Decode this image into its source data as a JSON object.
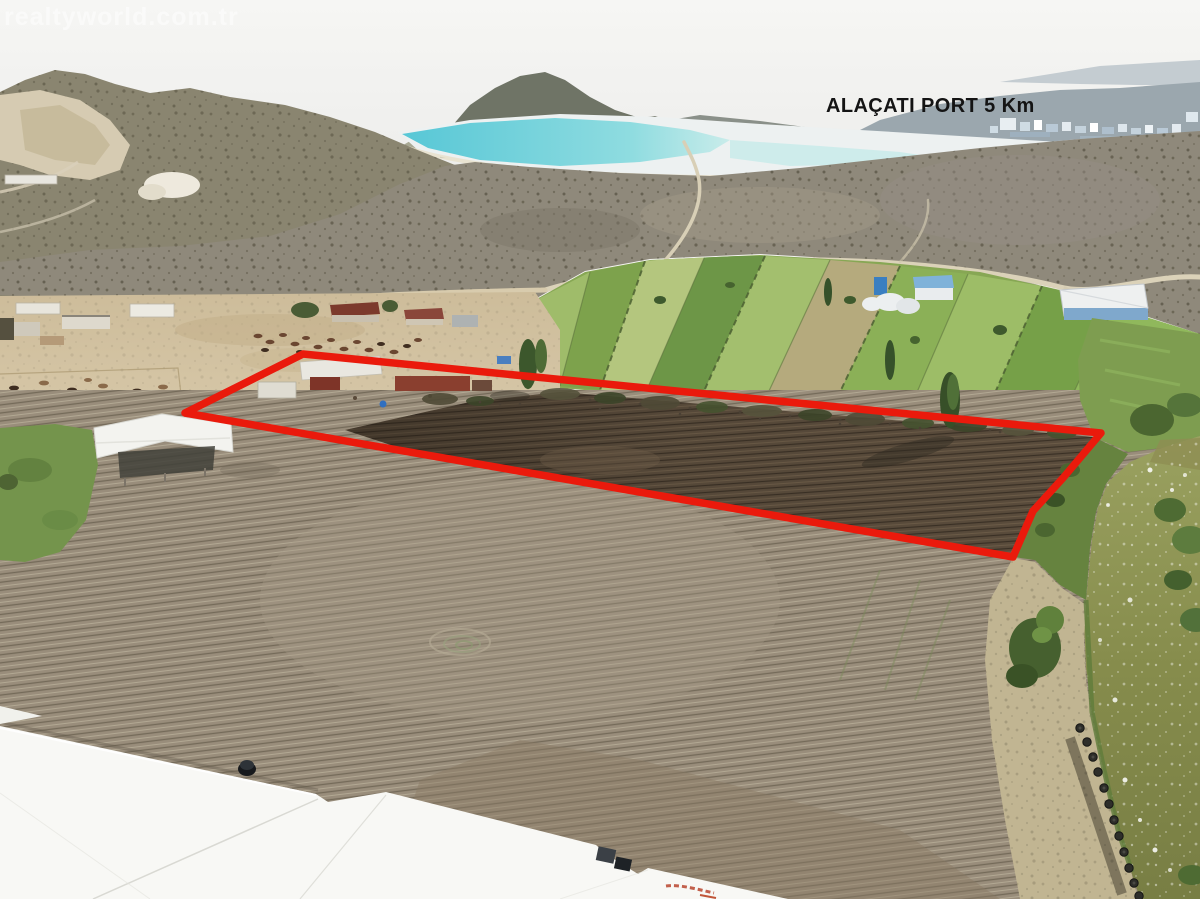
{
  "photo": {
    "watermark": "realtyworld.com.tr",
    "distance_label": "ALAÇATI PORT 5 Km"
  },
  "palette": {
    "parcel_outline": "#ea1a0c",
    "label_text": "#141414",
    "watermark_text": "rgba(255,255,255,0.52)",
    "sky": "#f4f4f1",
    "sea_turquoise": "#57c7d6",
    "river_water": "#868c4c",
    "green_fields": "#87a754",
    "plowed_soil_light": "#998d7b",
    "parcel_soil_dark": "#5a4c3c",
    "paddock_dirt": "#cfbe9d",
    "scrubland": "#8f897b",
    "greenhouse_roof": "#f8f8f5"
  }
}
